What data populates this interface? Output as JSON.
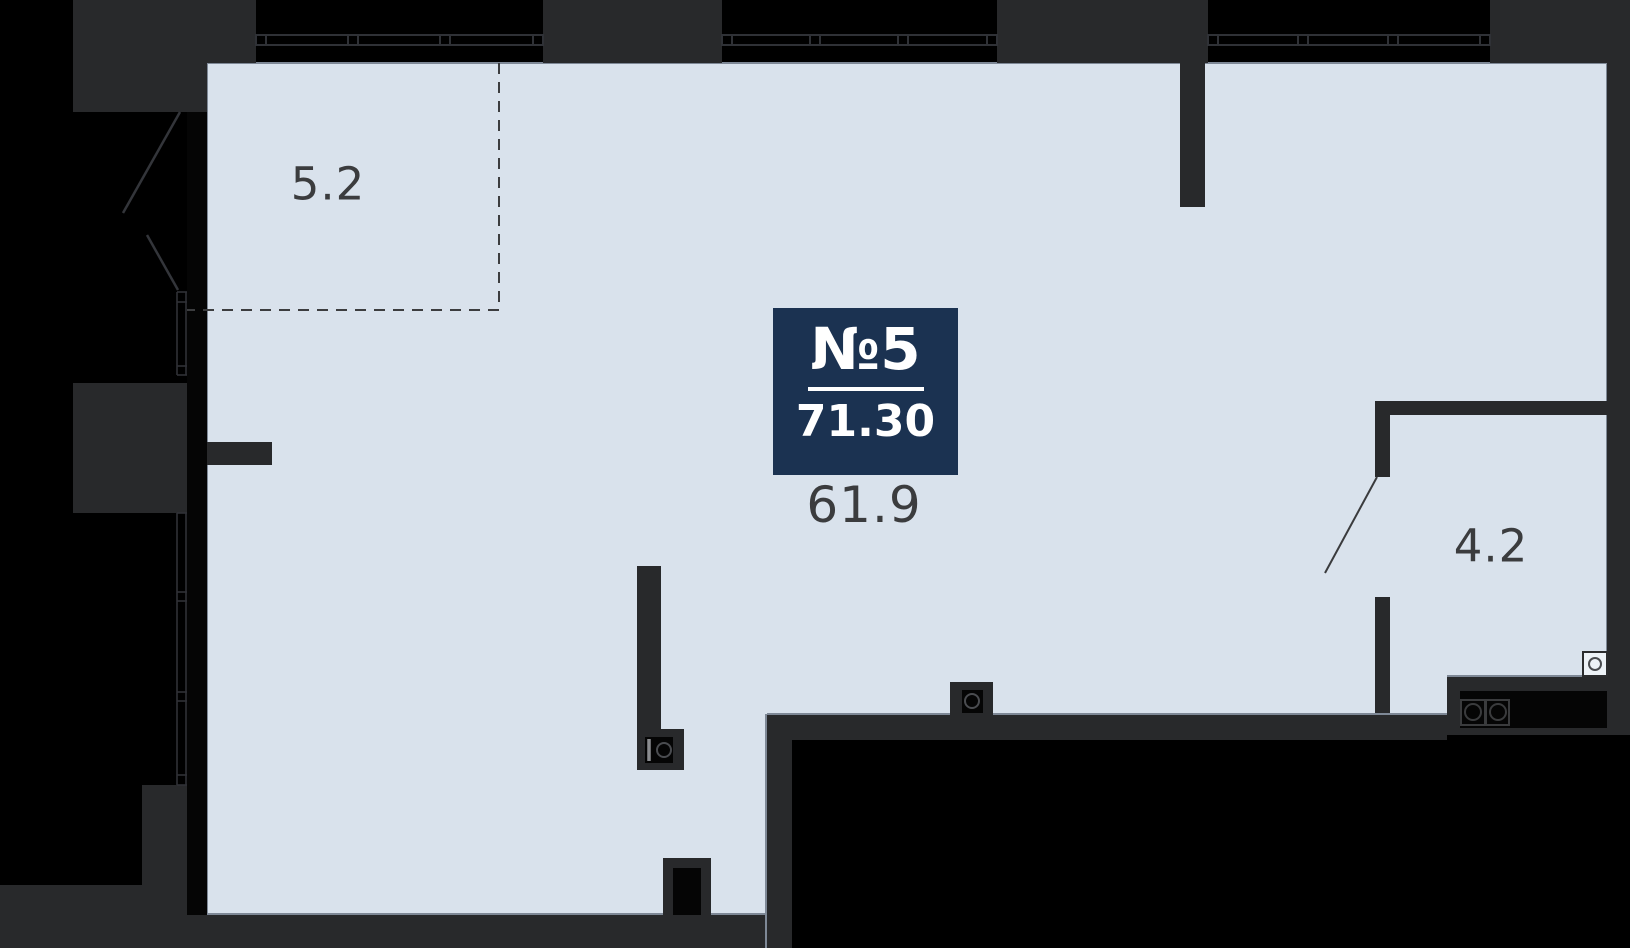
{
  "floorplan": {
    "unit": {
      "number_label": "№5",
      "total_area": "71.30"
    },
    "areas": [
      {
        "label": "5.2"
      },
      {
        "label": "61.9"
      },
      {
        "label": "4.2"
      }
    ],
    "colors": {
      "background": "#000000",
      "floor": "#D9E2EC",
      "floor_edge": "#7E8896",
      "wall": "#28292B",
      "wall_black": "#050505",
      "accent": "#1B3251",
      "label_text": "#3B3C3E",
      "badge_text": "#FFFFFF"
    },
    "icons": {
      "top_windows": "window-glazing-icon",
      "left_window": "window-glazing-icon",
      "left_opening": "door-swing-icon",
      "bath_door": "door-swing-icon",
      "wall_fixture": "sink-icon",
      "floor_fixture": "toilet-icon",
      "counter_fixture": "stove-burners-icon",
      "corner_fixture": "washing-machine-icon"
    }
  }
}
